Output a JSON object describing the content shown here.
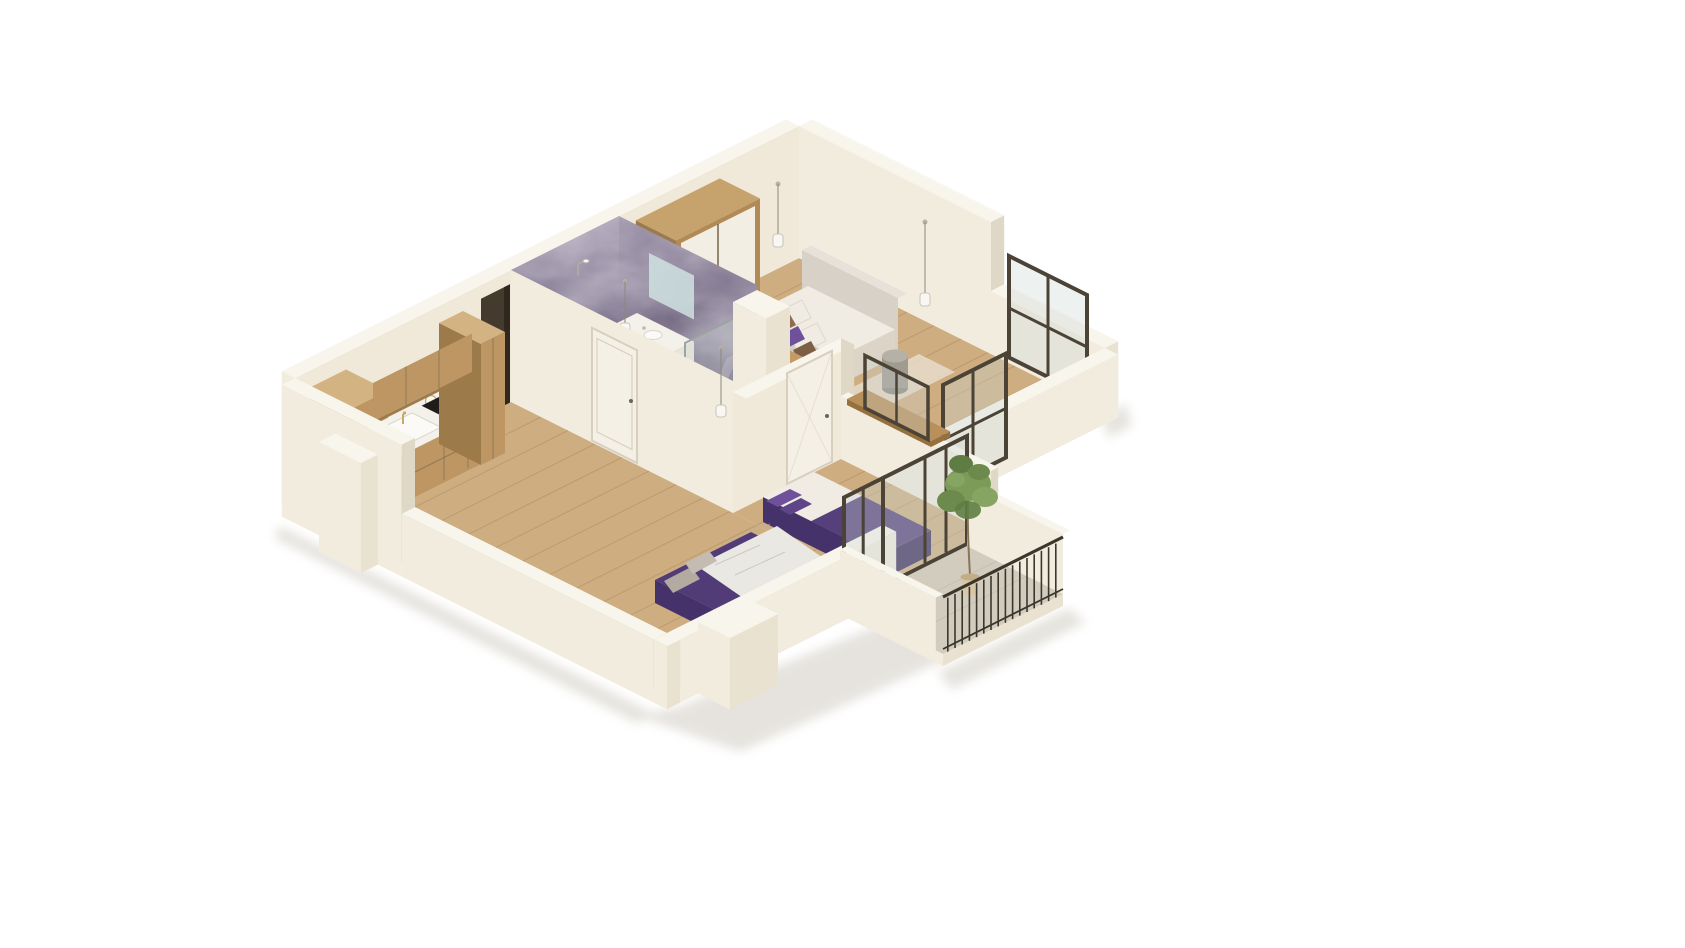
{
  "scene": {
    "title": "3D isometric cutaway floor plan render of a one-bedroom apartment",
    "view": "isometric cutaway render",
    "background": "#ffffff"
  },
  "palette": {
    "bg": "#ffffff",
    "wall_a": "#f2ecdf",
    "wall_b": "#eae2d1",
    "wall_c": "#f0e9da",
    "wall_d": "#e0d8c6",
    "wall_top": "#f8f5ec",
    "floor_wood": "#cead81",
    "plank": "#aa8457",
    "concrete": "#d2ccbf",
    "marble_hi": "#a99fb4",
    "marble_mid": "#7a7089",
    "marble_lo": "#5f5472",
    "bath_floor_hi": "#b7c3bd",
    "bath_floor_lo": "#8fa09b",
    "glass": "#ccd8d3",
    "glassline": "#9aa59f",
    "frame": "#4a4336",
    "railing": "#3b362c",
    "door_dark": "#453a2e",
    "door_dark_edge": "#30271e",
    "white_door": "#f5f0e6",
    "door_line": "#d8d0bf",
    "cab_wood": "#bd9663",
    "cab_wood_dark": "#9d7a4a",
    "cab_wood_top": "#d4b383",
    "counter": "#f3f1ea",
    "sink": "#fbfaf7",
    "cooktop": "#1f1c19",
    "oven": "#2f2b26",
    "steel": "#aeaaa3",
    "appliance": "#3d4878",
    "gold": "#c9a96a",
    "wardrobe_wood": "#b18a58",
    "wardrobe_wood_dark": "#9c7a4c",
    "wardrobe_wood_top": "#c6a26c",
    "wardrobe_door": "#f3eee3",
    "headboard": "#d7d1c7",
    "headboard_top": "#e7e2d9",
    "bedding": "#f0ece4",
    "bedding_side": "#e5ded1",
    "bedding_dark": "#dcd4c6",
    "gray_throw": "#d2cdc2",
    "purple": "#523c78",
    "purple_side": "#46326a",
    "purple_dark": "#3e2c5c",
    "purple_blanket": "#55407c",
    "purple_pillow": "#6f519b",
    "purple_pillow2": "#5d4587",
    "brown_pillow": "#8d6c4f",
    "brown_pillow2": "#7d5f45",
    "gray_pillow": "#b3aaa0",
    "gray_pillow2": "#c4bcb2",
    "throw": "#eae8e3",
    "vein": "#b9b3ac",
    "rug": "#e9dfcf",
    "stool_top": "#b6b1a7",
    "stool_body": "#a09b91",
    "stool_base": "#908b81",
    "desk": "#b8905c",
    "desk_dark": "#96703d",
    "console": "#a8834f",
    "console_top": "#c29b66",
    "console_side": "#93703f",
    "plant_a": "#7c9a58",
    "plant_b": "#6b8a4c",
    "plant_c": "#87a562",
    "plant_d": "#5f7d42",
    "pot": "#d8c7a4",
    "pot_dark": "#c2ad86",
    "trunk": "#8a7456",
    "cord": "#8c887e",
    "mirror": "#cfe2e0",
    "shadow": "#b9b2a4",
    "white": "#f8f7f3",
    "tile": "#b9b3a5",
    "gap": "#6b5b3f"
  },
  "rooms": [
    {
      "id": "kitchen",
      "label": "Kitchen",
      "floor": "light oak plank",
      "features": [
        "wood base cabinets",
        "white countertop",
        "white sink",
        "gold faucet",
        "black cooktop",
        "tall oven cabinet",
        "built-in oven",
        "blue appliance",
        "upper wall cabinets",
        "tall pantry cabinet"
      ]
    },
    {
      "id": "living-room",
      "label": "Living room",
      "floor": "light oak plank",
      "features": [
        "purple sofa bed",
        "white marble-pattern throw",
        "two gray cushions"
      ]
    },
    {
      "id": "bathroom",
      "label": "Bathroom",
      "walls": "purple marble panels",
      "floor": "gray-green tile",
      "features": [
        "walk-in shower with glass screen",
        "chrome shower head",
        "toilet",
        "white vanity with basin",
        "mirror",
        "pendant light",
        "white door"
      ]
    },
    {
      "id": "hallway",
      "label": "Hallway",
      "floor": "light oak plank",
      "features": [
        "dark entrance door",
        "white interior door",
        "pendant light"
      ]
    },
    {
      "id": "bedroom",
      "label": "Bedroom",
      "floor": "light oak plank",
      "features": [
        "wood-framed wardrobe with white doors",
        "double bed",
        "white duvet",
        "gray foot throw",
        "purple and brown pillows",
        "upholstered headboard",
        "wood foot console",
        "gray side stool",
        "beige rug",
        "two pendant lights",
        "black-framed window",
        "interior glass window"
      ]
    },
    {
      "id": "small-room",
      "label": "Small room",
      "floor": "light oak plank",
      "features": [
        "single bed with purple bedding",
        "purple pillows",
        "wood desk top on partition"
      ]
    },
    {
      "id": "balcony",
      "label": "Balcony",
      "floor": "concrete",
      "features": [
        "dark metal railing",
        "potted plant",
        "glass sliding doors",
        "white parapet walls"
      ]
    }
  ],
  "counts": {
    "pendant_lights": 4,
    "windows": 3,
    "glass_doors": 3,
    "hinged_doors": 3,
    "plants": 1
  }
}
